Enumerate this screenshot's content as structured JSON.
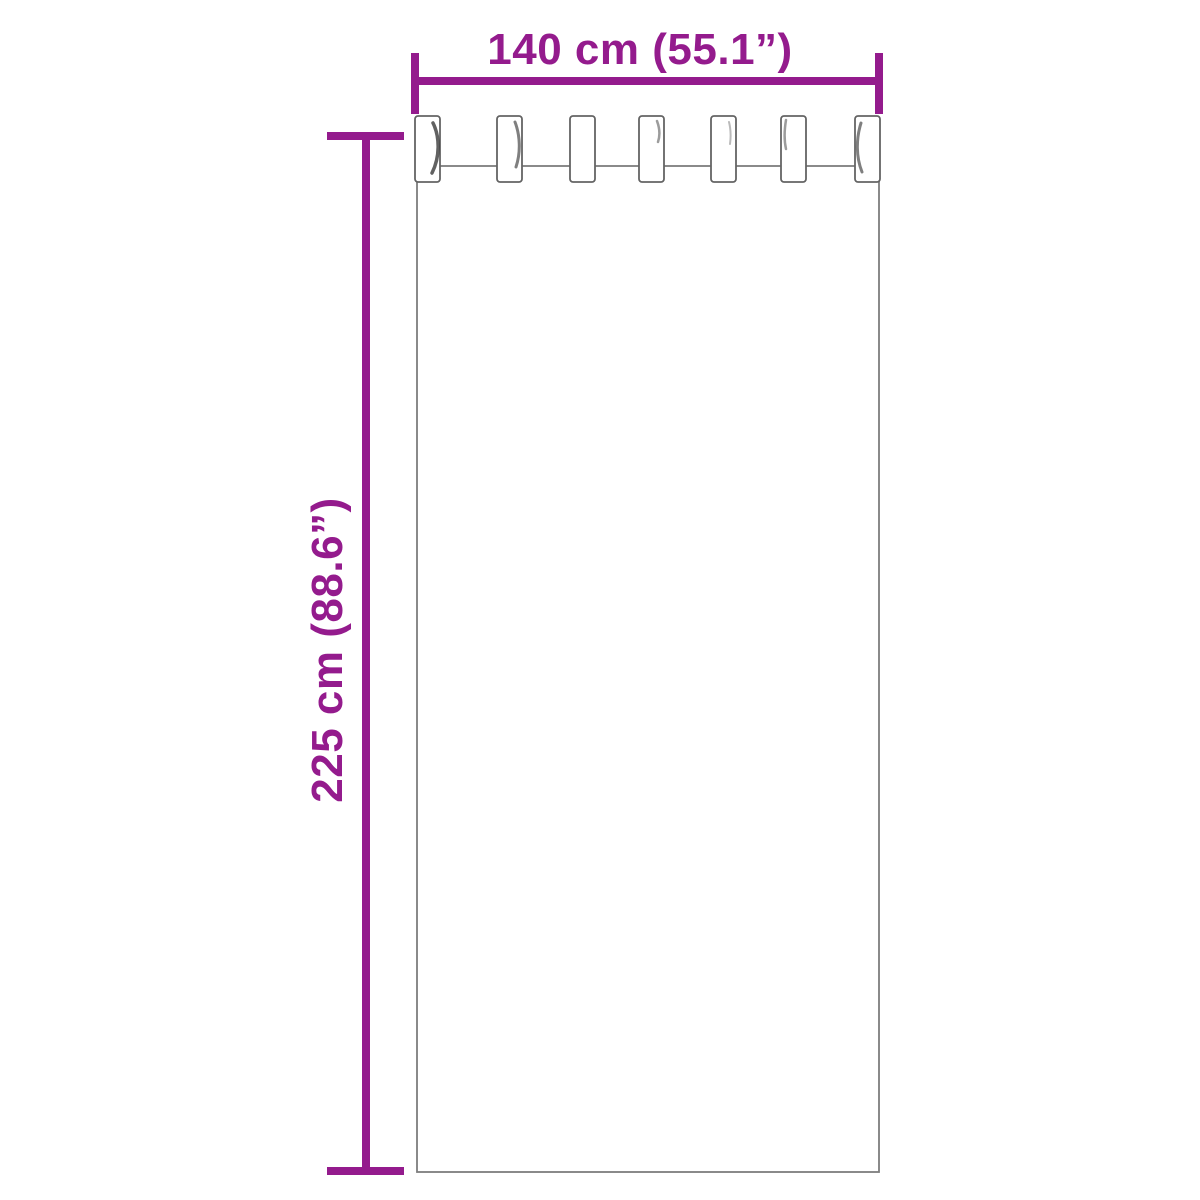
{
  "page": {
    "background": "#ffffff"
  },
  "colors": {
    "accent": "#941b8d",
    "outline": "#7e7e7e",
    "outline_dark": "#646464",
    "shade": "#3a3a3a"
  },
  "dimensions": {
    "width_label": "140 cm (55.1”)",
    "height_label": "225 cm (88.6”)"
  },
  "diagram": {
    "type": "tab-top-curtain-dimension-diagram",
    "width_dimension": {
      "line": {
        "x1": 415,
        "y": 81,
        "x2": 879
      },
      "cap_y1": 53,
      "cap_y2": 114,
      "label_x": 640,
      "label_y": 64
    },
    "height_dimension": {
      "line": {
        "x": 366,
        "y1": 133,
        "y2": 1171
      },
      "cap_x1": 327,
      "cap_x2": 404,
      "cap_top_y": 136,
      "cap_bottom_y": 1171,
      "label_x": 342,
      "label_y": 650
    },
    "panel": {
      "x": 417,
      "y": 166,
      "w": 462,
      "h": 1006
    },
    "tab_count": 7,
    "tabs": {
      "y": 116,
      "width": 25,
      "height": 66,
      "radius": 3,
      "items": [
        {
          "x": 415,
          "shade": "M433 123 C440 137 440 157 432 173",
          "shade_width": 3.5,
          "shade_opacity": 0.8
        },
        {
          "x": 497,
          "shade": "M515 122 C520 135 521 152 516 167",
          "shade_width": 3.0,
          "shade_opacity": 0.65
        },
        {
          "x": 570,
          "shade": "",
          "shade_width": 0,
          "shade_opacity": 0
        },
        {
          "x": 639,
          "shade": "M657 121 C660 129 660 136 658 142",
          "shade_width": 2.5,
          "shade_opacity": 0.5
        },
        {
          "x": 711,
          "shade": "M729 122 C731 130 731 137 730 144",
          "shade_width": 2.0,
          "shade_opacity": 0.35
        },
        {
          "x": 781,
          "shade": "M786 120 C784 132 784 140 786 149",
          "shade_width": 2.5,
          "shade_opacity": 0.5
        },
        {
          "x": 855,
          "shade": "M861 123 C856 139 856 157 862 172",
          "shade_width": 3.0,
          "shade_opacity": 0.65
        }
      ]
    }
  }
}
